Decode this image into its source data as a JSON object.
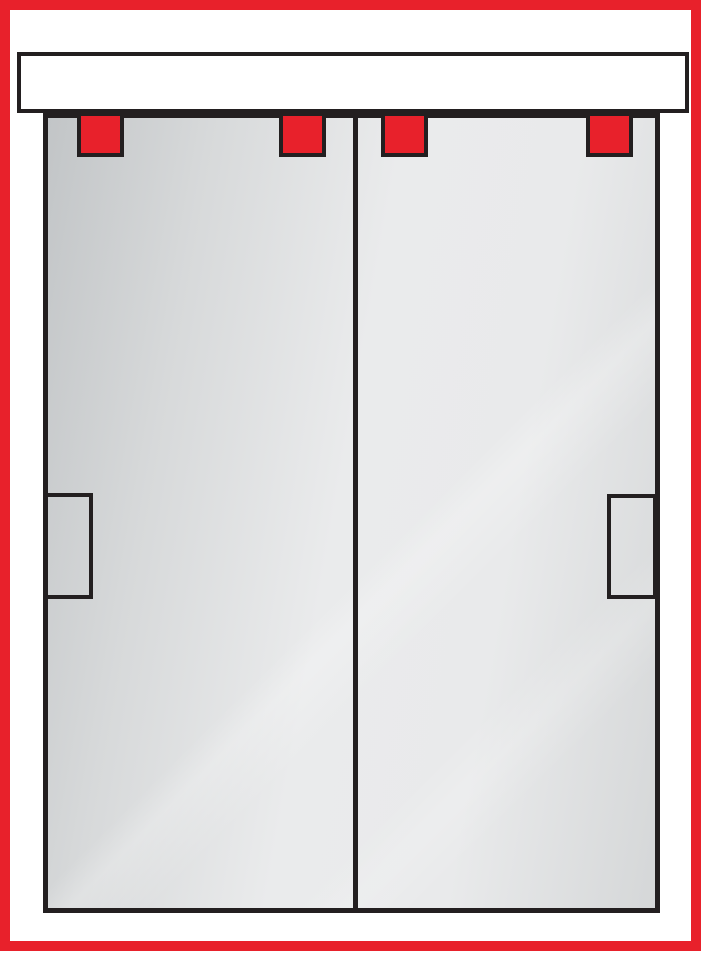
{
  "diagram": {
    "type": "sliding-bypass-closet-doors",
    "colors": {
      "frame-red": "#E8212B",
      "roller-red": "#E8212B",
      "ink": "#231F20",
      "page-white": "#FFFFFF",
      "panel-dark": "#C2C5C7",
      "panel-light": "#EAEBEC",
      "panel-mid": "#D5D7D8"
    },
    "track": {
      "name": "header-track"
    },
    "panels": [
      {
        "name": "left-door-panel",
        "geom": {
          "x": 0,
          "y": 0,
          "w": 305,
          "h": 790
        }
      },
      {
        "name": "right-door-panel",
        "geom": {
          "x": 310,
          "y": 0,
          "w": 297,
          "h": 790
        }
      }
    ],
    "divider": {
      "geom": {
        "x": 305,
        "y": 0,
        "w": 5,
        "h": 790
      }
    },
    "rollers": [
      {
        "geom": {
          "x": 29,
          "y": -6,
          "w": 47,
          "h": 45
        }
      },
      {
        "geom": {
          "x": 231,
          "y": -6,
          "w": 47,
          "h": 45
        }
      },
      {
        "geom": {
          "x": 333,
          "y": -6,
          "w": 47,
          "h": 45
        }
      },
      {
        "geom": {
          "x": 538,
          "y": -6,
          "w": 47,
          "h": 45
        }
      }
    ],
    "handles": [
      {
        "side": "left",
        "geom": {
          "x": -4,
          "y": 375,
          "w": 49,
          "h": 106
        }
      },
      {
        "side": "right",
        "geom": {
          "x": 559,
          "y": 376,
          "w": 50,
          "h": 105
        }
      }
    ]
  }
}
